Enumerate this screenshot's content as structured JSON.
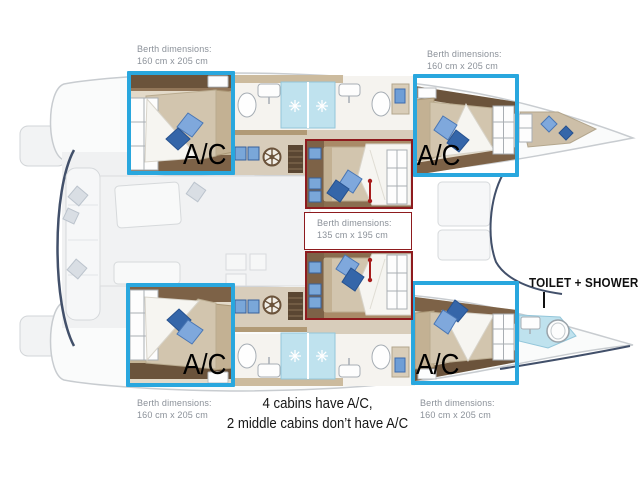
{
  "diagram": {
    "title": "Catamaran cabin layout",
    "ac_label": "A/C",
    "toilet_shower_label": "TOILET + SHOWER",
    "caption": {
      "line1": "4 cabins have A/C,",
      "line2": "2 middle cabins don’t have A/C"
    },
    "berth_labels": {
      "top_left": {
        "line1": "Berth dimensions:",
        "line2": "160 cm x 205 cm"
      },
      "top_right": {
        "line1": "Berth dimensions:",
        "line2": "160 cm x 205 cm"
      },
      "bottom_left": {
        "line1": "Berth dimensions:",
        "line2": "160 cm x 205 cm"
      },
      "bottom_right": {
        "line1": "Berth dimensions:",
        "line2": "160 cm x 205 cm"
      },
      "middle": {
        "line1": "Berth dimensions:",
        "line2": "135 cm x 195 cm"
      }
    },
    "colors": {
      "highlight_blue": "#29a7de",
      "highlight_red": "#8e1b1e",
      "arrow_red": "#a81d1d",
      "shower_blue": "#bfe2ee",
      "wood_dark": "#6b533b",
      "bed_tan": "#d2c5ae",
      "pillow_light_blue": "#7fa8dc",
      "pillow_dark_blue": "#3566a9"
    }
  }
}
